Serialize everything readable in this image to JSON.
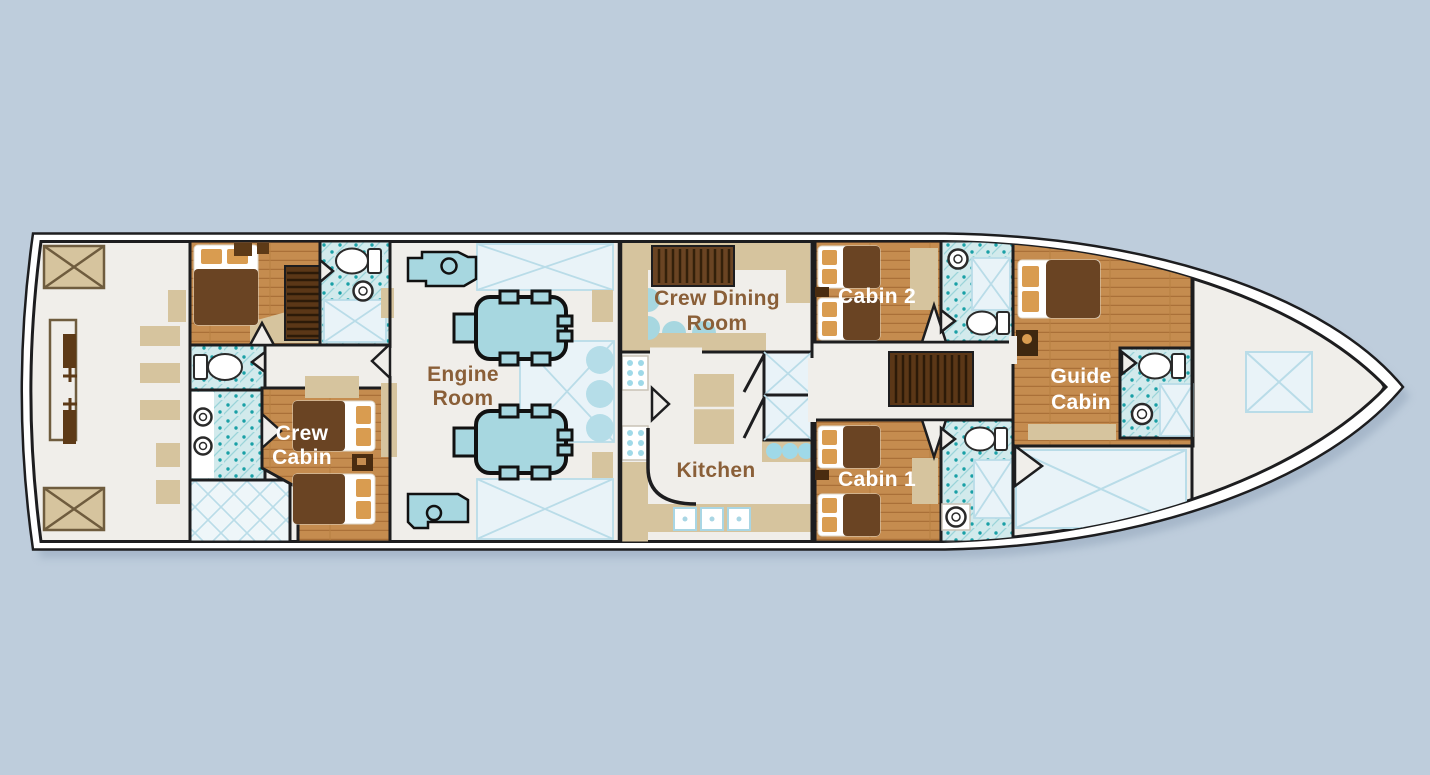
{
  "diagram_type": "yacht-lower-deck-floor-plan",
  "rooms": {
    "crew_cabin": {
      "line1": "Crew",
      "line2": "Cabin"
    },
    "engine_room": {
      "line1": "Engine",
      "line2": "Room"
    },
    "crew_dining_room": {
      "line1": "Crew Dining",
      "line2": "Room"
    },
    "kitchen": {
      "label": "Kitchen"
    },
    "cabin_1": {
      "label": "Cabin 1"
    },
    "cabin_2": {
      "label": "Cabin 2"
    },
    "guide_cabin": {
      "line1": "Guide",
      "line2": "Cabin"
    }
  },
  "colors": {
    "background": "#becddc",
    "hull_outline": "#1d1d1f",
    "floor": "#f0eeea",
    "wood": "#c58c4f",
    "tan": "#d6c49e",
    "dark_brown": "#5d3a17",
    "aqua": "#a7d7e0",
    "tile_teal": "#19a0a6",
    "hatch_blue": "#b9dce8",
    "label_brown": "#8a5f38",
    "label_white": "#ffffff"
  }
}
